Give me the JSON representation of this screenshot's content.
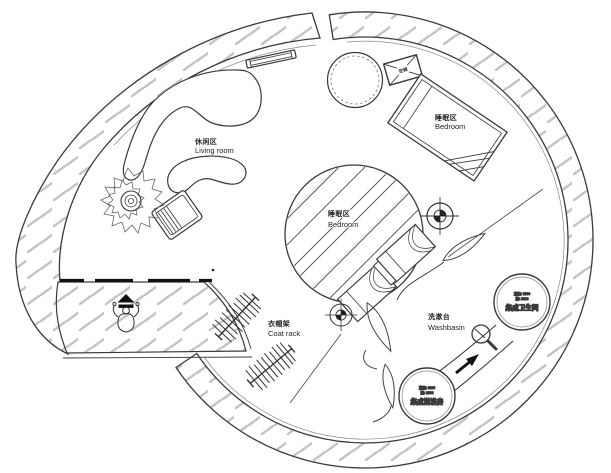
{
  "labels": {
    "living_room": {
      "zh": "休闲区",
      "en": "Living room"
    },
    "bedroom_right": {
      "zh": "睡眠区",
      "en": "Bedroom"
    },
    "bedroom_center": {
      "zh": "睡眠区",
      "en": "Bedroom"
    },
    "coat_rack": {
      "zh": "衣帽架",
      "en": "Coat rack"
    },
    "washbasin": {
      "zh": "洗漱台",
      "en": "Washbasin"
    }
  },
  "pods": {
    "bathroom": {
      "dim1": "直径: 1100",
      "dim2": "高: 2100",
      "name": "集成卫生间"
    },
    "shower": {
      "dim1": "直径: 1100",
      "dim2": "高: 2100",
      "name": "集成淋浴房"
    }
  },
  "equipment": {
    "ac_label": "空调"
  },
  "colors": {
    "line": "#3a3a3a",
    "hatch_dash": "#c4c4c4",
    "label_text": "#222222",
    "background": "#ffffff"
  }
}
